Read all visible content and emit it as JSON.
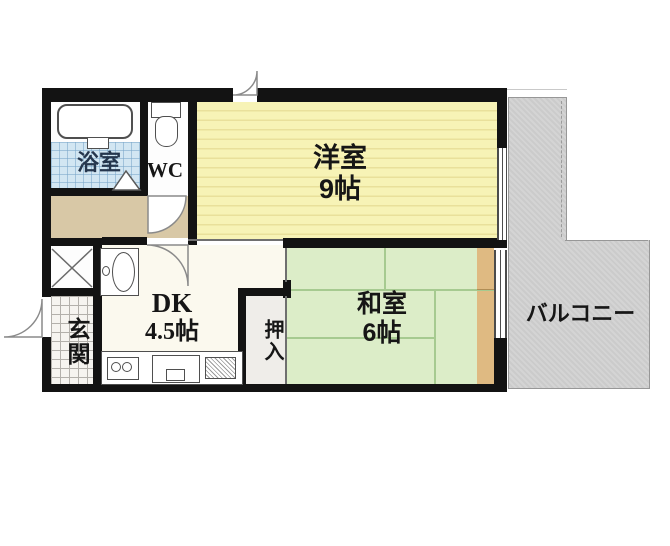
{
  "rooms": {
    "bathroom": {
      "label": "浴室"
    },
    "wc": {
      "label": "WC"
    },
    "western_room": {
      "label": "洋室",
      "size": "9帖"
    },
    "japanese_room": {
      "label": "和室",
      "size": "6帖"
    },
    "dk": {
      "label": "DK",
      "size": "4.5帖"
    },
    "closet": {
      "label": "押入"
    },
    "entrance": {
      "label": "玄関"
    },
    "balcony": {
      "label": "バルコニー"
    }
  },
  "colors": {
    "wall": "#131313",
    "western_room_floor": "#f7f3b6",
    "japanese_room_floor": "#dcedc8",
    "hallway_floor": "#d8c8a6",
    "bathroom_tile": "#d2e6f2",
    "entrance_tile": "#f6f4f0",
    "wood_strip": "#dfba82",
    "balcony": "#cbcbcb"
  }
}
